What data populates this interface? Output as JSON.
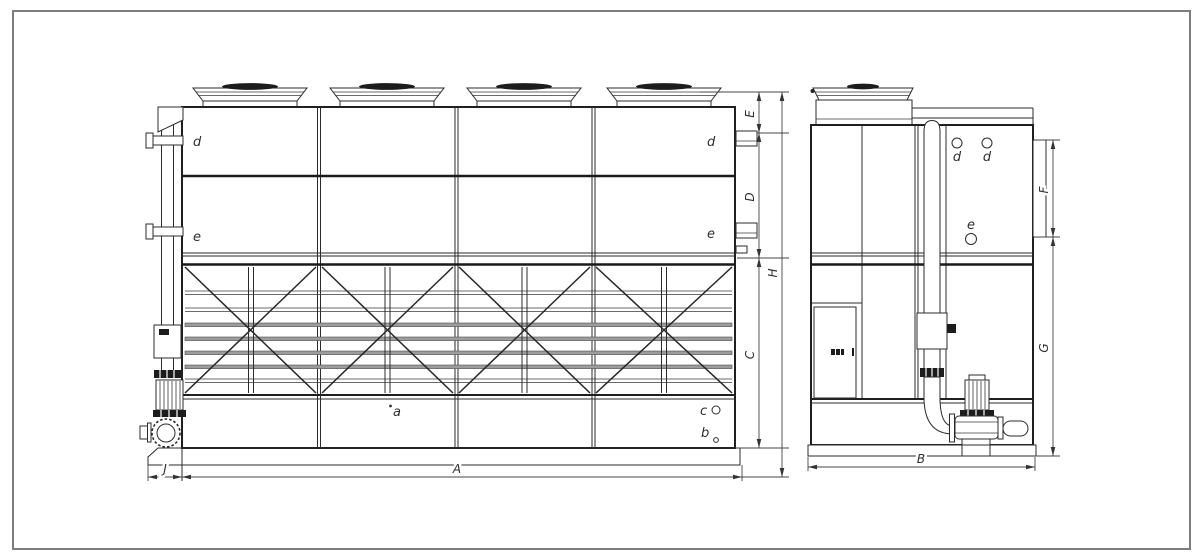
{
  "front_view": {
    "connection_labels": {
      "d_left": "d",
      "e_left": "e",
      "d_right": "d",
      "e_right": "e"
    },
    "part_labels": {
      "a": "a",
      "b": "b",
      "c": "c"
    },
    "dimensions": {
      "E": "E",
      "D": "D",
      "C": "C",
      "H": "H",
      "A": "A",
      "J": "J"
    }
  },
  "side_view": {
    "connection_labels": {
      "d1": "d",
      "d2": "d",
      "e": "e"
    },
    "dimensions": {
      "F": "F",
      "G": "G",
      "B": "B"
    }
  }
}
